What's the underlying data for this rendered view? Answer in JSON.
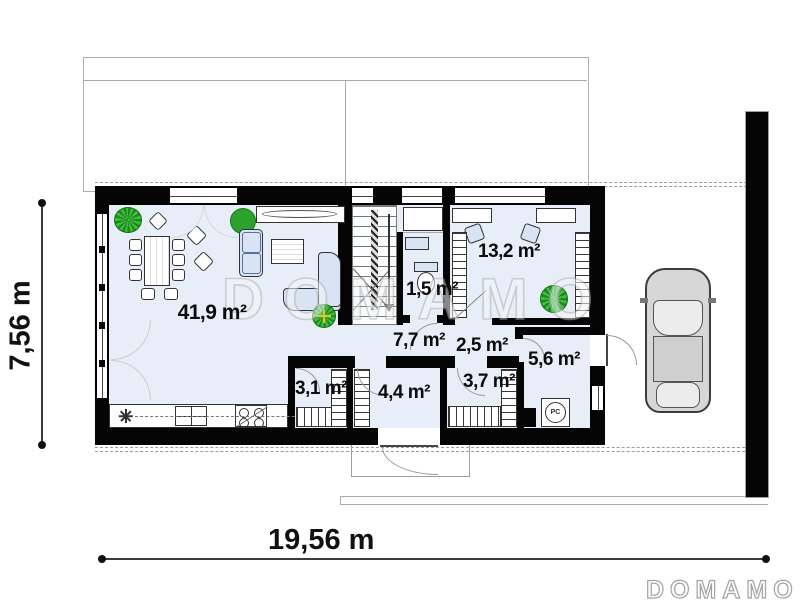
{
  "branding": {
    "watermark_text": "DOMAMO",
    "logo_text": "DOMAMO"
  },
  "dimensions": {
    "height_label": "7,56 m",
    "width_label": "19,56 m"
  },
  "rooms": [
    {
      "id": "living-dining-kitchen",
      "area_label": "41,9 m²"
    },
    {
      "id": "office-bedroom",
      "area_label": "13,2 m²"
    },
    {
      "id": "wc",
      "area_label": "1,5 m²"
    },
    {
      "id": "hall",
      "area_label": "7,7 m²"
    },
    {
      "id": "corridor",
      "area_label": "2,5 m²"
    },
    {
      "id": "entry-hall",
      "area_label": "5,6 m²"
    },
    {
      "id": "pantry",
      "area_label": "3,1 m²"
    },
    {
      "id": "storage-room",
      "area_label": "4,4 m²"
    },
    {
      "id": "wardrobe-room",
      "area_label": "3,7 m²"
    }
  ],
  "equipment": {
    "boiler_label": "PC"
  },
  "colors": {
    "walls": "#050505",
    "room_fill": "#e7eef7",
    "furniture_fill": "#d8e4f3",
    "plant_green": "#2ca12c",
    "watermark_gray": "#b2b2b2"
  }
}
